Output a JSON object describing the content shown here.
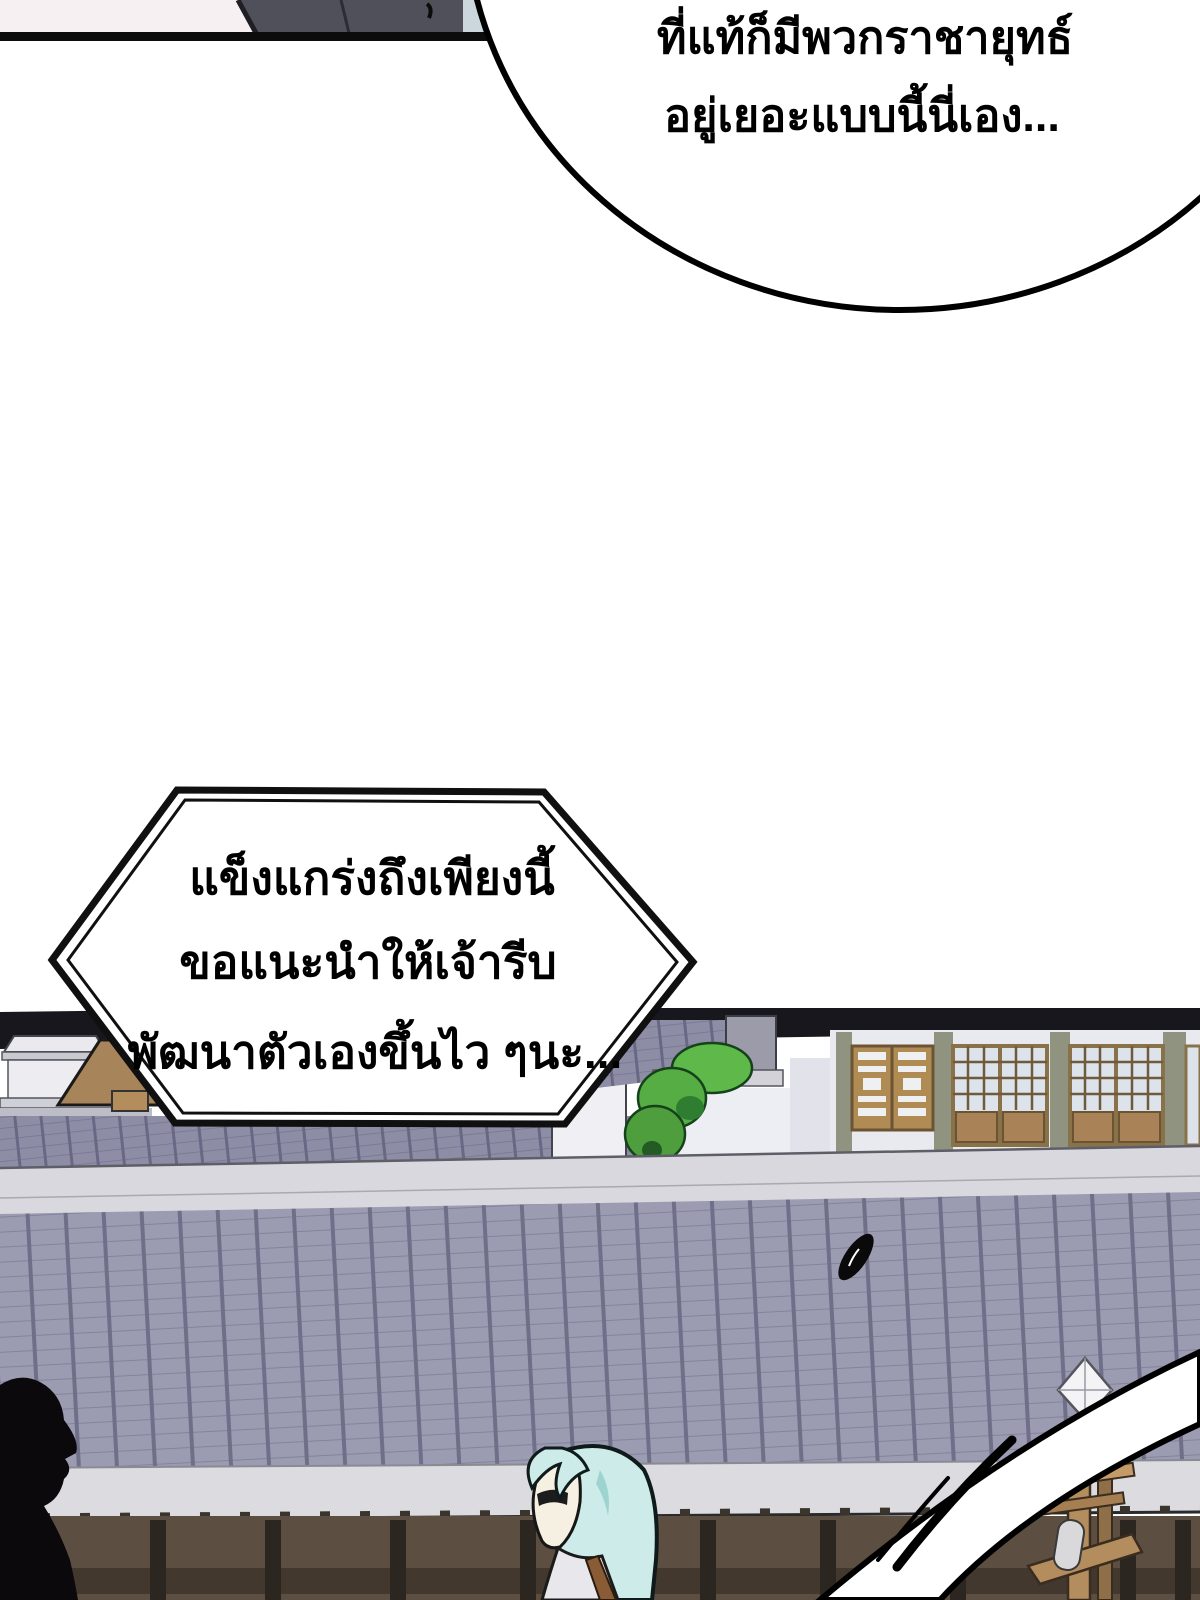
{
  "page": {
    "kind": "manga-webtoon-page",
    "language": "th",
    "background_color": "#ffffff"
  },
  "speech_bubble_top": {
    "shape": "ellipse-cut-by-top-edge",
    "line1": "ที่แท้ก็มีพวกราชายุทธ์",
    "line2": "อยู่เยอะแบบนี้นี่เอง..."
  },
  "speech_box_hexagon": {
    "shape": "double-border-hexagon",
    "line1": "แข็งแกร่งถึงเพียงนี้",
    "line2": "ขอแนะนำให้เจ้ารีบ",
    "line3": "พัฒนาตัวเองขึ้นไว ๆนะ..."
  },
  "scene": {
    "description_elements": [
      "previous-panel-bottom-strip",
      "tiled-roof-foreground",
      "long-wall-band",
      "left-white-pavilion",
      "tan-side-roof",
      "green-tree",
      "lattice-window-building",
      "dark-eave-band",
      "white-motion-slash",
      "thrown-black-object",
      "wooden-standard-with-finial",
      "black-silhouette-head",
      "cyan-haired-character"
    ]
  },
  "colors": {
    "ink": "#000000",
    "paper": "#ffffff",
    "strip_pink": "#f7f0f2",
    "strip_gray_cloth": "#50505a",
    "strip_blue": "#ccd7dd",
    "dark_eave": "#17171d",
    "facade_wall": "#e9e9f0",
    "pilaster_green_gray": "#8f937f",
    "window_wood": "#aa8258",
    "window_frame": "#6b5434",
    "window_pane": "#dde3ea",
    "tree_green": "#5fb84a",
    "tree_shadow": "#2e7d31",
    "bg_roof_tile": "#8d8da6",
    "fg_roof_tile": "#9b9bb2",
    "fg_roof_line": "#7f7f99",
    "wall_band": "#d8d8de",
    "eave_band": "#dcdce0",
    "under_eave_wood": "#5c4f42",
    "wood_rail": "#42382e",
    "wood_post": "#2c2620",
    "pavilion_white": "#efeff3",
    "tan_roof": "#a8845a",
    "hair_cyan": "#cdebe8",
    "skin_pale": "#f6f0e2",
    "standard_wood": "#b48d5e",
    "plaque_gray": "#d9d9db"
  }
}
